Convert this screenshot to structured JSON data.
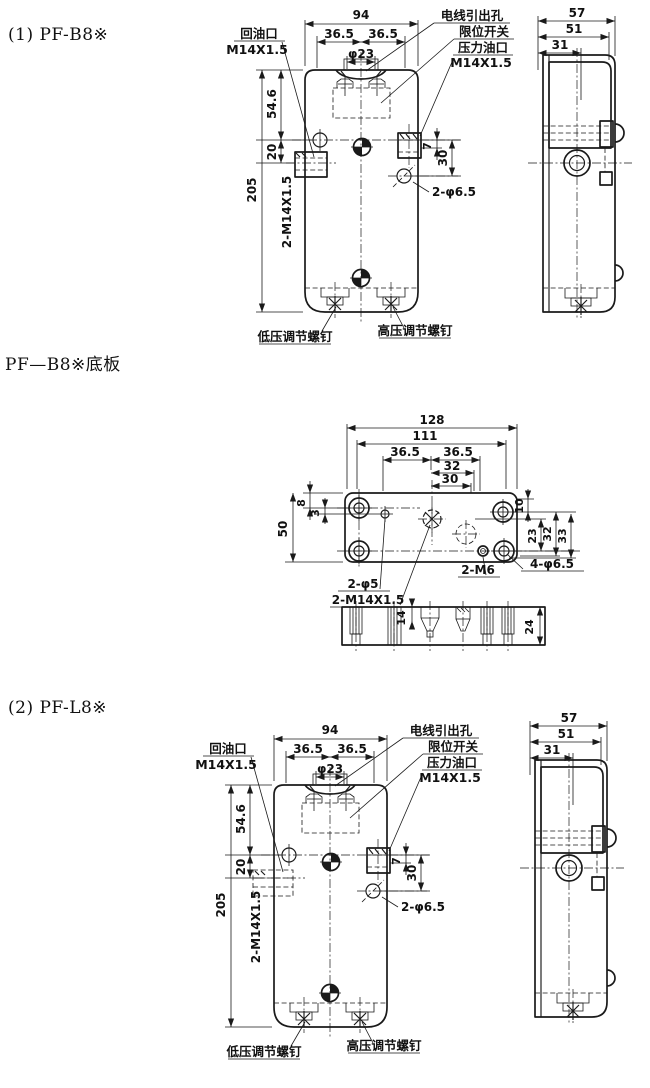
{
  "page": {
    "background": "#ffffff",
    "line_color": "#1a1a1a"
  },
  "fig1": {
    "title": "(1) PF-B8※",
    "front": {
      "dim_94": "94",
      "dim_36_5_left": "36.5",
      "dim_36_5_right": "36.5",
      "dim_phi23": "φ23",
      "dim_54_6": "54.6",
      "dim_20": "20",
      "dim_205": "205",
      "dim_7": "7",
      "dim_30": "30",
      "label_2_m14": "2-M14X1.5",
      "label_2_phi6_5": "2-φ6.5",
      "label_return_port": "回油口",
      "label_return_thread": "M14X1.5",
      "label_wire_outlet": "电线引出孔",
      "label_limit_switch": "限位开关",
      "label_pressure_port": "压力油口",
      "label_pressure_thread": "M14X1.5",
      "label_low_pressure_screw": "低压调节螺钉",
      "label_high_pressure_screw": "高压调节螺钉"
    },
    "side": {
      "dim_57": "57",
      "dim_51": "51",
      "dim_31": "31"
    }
  },
  "fig2": {
    "title": "PF—B8※底板",
    "plate": {
      "dim_128": "128",
      "dim_111": "111",
      "dim_36_5_left": "36.5",
      "dim_36_5_right": "36.5",
      "dim_32": "32",
      "dim_30": "30",
      "dim_8": "8",
      "dim_3": "3",
      "dim_50": "50",
      "dim_10": "10",
      "dim_23": "23",
      "dim_32_right": "32",
      "dim_33": "33",
      "label_2_phi5": "2-φ5",
      "label_2_m14": "2-M14X1.5",
      "label_2_m6": "2-M6",
      "label_4_phi6_5": "4-φ6.5"
    },
    "section": {
      "dim_14": "14",
      "dim_24": "24"
    }
  },
  "fig3": {
    "title": "(2) PF-L8※",
    "front": {
      "dim_94": "94",
      "dim_36_5_left": "36.5",
      "dim_36_5_right": "36.5",
      "dim_phi23": "φ23",
      "dim_54_6": "54.6",
      "dim_20": "20",
      "dim_205": "205",
      "dim_7": "7",
      "dim_30": "30",
      "label_2_m14": "2-M14X1.5",
      "label_2_phi6_5": "2-φ6.5",
      "label_return_port": "回油口",
      "label_return_thread": "M14X1.5",
      "label_wire_outlet": "电线引出孔",
      "label_limit_switch": "限位开关",
      "label_pressure_port": "压力油口",
      "label_pressure_thread": "M14X1.5",
      "label_low_pressure_screw": "低压调节螺钉",
      "label_high_pressure_screw": "高压调节螺钉"
    },
    "side": {
      "dim_57": "57",
      "dim_51": "51",
      "dim_31": "31"
    }
  }
}
